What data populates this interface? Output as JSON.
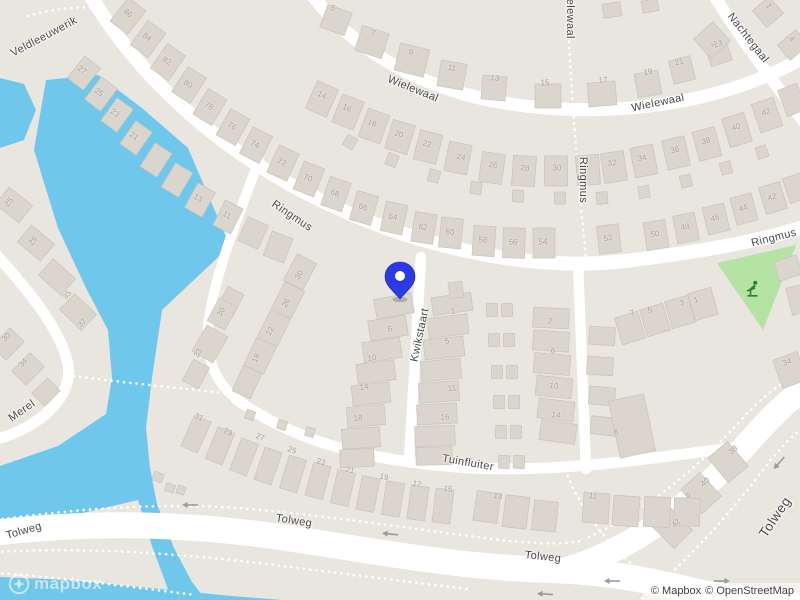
{
  "marker": {
    "x": 400,
    "y": 284
  },
  "branding": {
    "logo_text": "mapbox"
  },
  "attribution": {
    "mapbox": "© Mapbox",
    "openstreetmap": "© OpenStreetMap"
  },
  "colors": {
    "water": "#6fc7ec",
    "land": "#e9e6e0",
    "road": "#ffffff",
    "building": "#dad5cd",
    "building_outline": "#c9c3ba",
    "park": "#b5e3a4",
    "park_icon": "#2e7d32",
    "pin": "#2b3ae2",
    "street_label": "#474747",
    "house_number": "#a5a198"
  },
  "street_labels": [
    {
      "text": "Veldleeuwerik",
      "x": 44,
      "y": 37,
      "rot": -28
    },
    {
      "text": "Wielewaal",
      "x": 413,
      "y": 89,
      "rot": 22
    },
    {
      "text": "Wielewaal",
      "x": 570,
      "y": 12,
      "rot": 90
    },
    {
      "text": "Wielewaal",
      "x": 658,
      "y": 103,
      "rot": -12
    },
    {
      "text": "Nachtegaal",
      "x": 748,
      "y": 38,
      "rot": 52
    },
    {
      "text": "Ringmus",
      "x": 292,
      "y": 216,
      "rot": 34
    },
    {
      "text": "Ringmus",
      "x": 583,
      "y": 180,
      "rot": 90
    },
    {
      "text": "Ringmus",
      "x": 774,
      "y": 238,
      "rot": -14
    },
    {
      "text": "Kwikstaart",
      "x": 420,
      "y": 335,
      "rot": -78
    },
    {
      "text": "Tuinfluiter",
      "x": 468,
      "y": 463,
      "rot": 10
    },
    {
      "text": "Merel",
      "x": 22,
      "y": 411,
      "rot": -35
    },
    {
      "text": "Tolweg",
      "x": 24,
      "y": 531,
      "rot": -16
    },
    {
      "text": "Tolweg",
      "x": 294,
      "y": 521,
      "rot": 9
    },
    {
      "text": "Tolweg",
      "x": 543,
      "y": 557,
      "rot": 6
    },
    {
      "text": "Tolweg",
      "x": 775,
      "y": 517,
      "rot": -56,
      "big": true
    }
  ],
  "house_numbers": [
    {
      "n": "86",
      "x": 128,
      "y": 13,
      "rot": 38
    },
    {
      "n": "84",
      "x": 147,
      "y": 37,
      "rot": 36
    },
    {
      "n": "82",
      "x": 167,
      "y": 61,
      "rot": 35
    },
    {
      "n": "80",
      "x": 188,
      "y": 84,
      "rot": 33
    },
    {
      "n": "78",
      "x": 209,
      "y": 106,
      "rot": 31
    },
    {
      "n": "76",
      "x": 232,
      "y": 126,
      "rot": 29
    },
    {
      "n": "74",
      "x": 255,
      "y": 144,
      "rot": 27
    },
    {
      "n": "72",
      "x": 282,
      "y": 162,
      "rot": 25
    },
    {
      "n": "70",
      "x": 308,
      "y": 178,
      "rot": 22
    },
    {
      "n": "68",
      "x": 335,
      "y": 193,
      "rot": 19
    },
    {
      "n": "66",
      "x": 363,
      "y": 207,
      "rot": 16
    },
    {
      "n": "64",
      "x": 393,
      "y": 217,
      "rot": 12
    },
    {
      "n": "62",
      "x": 423,
      "y": 227,
      "rot": 9
    },
    {
      "n": "60",
      "x": 450,
      "y": 232,
      "rot": 6
    },
    {
      "n": "58",
      "x": 483,
      "y": 240,
      "rot": 4
    },
    {
      "n": "56",
      "x": 513,
      "y": 242,
      "rot": 2
    },
    {
      "n": "54",
      "x": 543,
      "y": 242,
      "rot": 0
    },
    {
      "n": "52",
      "x": 608,
      "y": 238,
      "rot": -7
    },
    {
      "n": "50",
      "x": 655,
      "y": 234,
      "rot": -9
    },
    {
      "n": "48",
      "x": 685,
      "y": 227,
      "rot": -11
    },
    {
      "n": "46",
      "x": 715,
      "y": 218,
      "rot": -13
    },
    {
      "n": "44",
      "x": 743,
      "y": 208,
      "rot": -15
    },
    {
      "n": "42",
      "x": 772,
      "y": 197,
      "rot": -17
    },
    {
      "n": "27",
      "x": 82,
      "y": 70,
      "rot": 38
    },
    {
      "n": "25",
      "x": 99,
      "y": 92,
      "rot": 37
    },
    {
      "n": "23",
      "x": 115,
      "y": 113,
      "rot": 36
    },
    {
      "n": "21",
      "x": 134,
      "y": 136,
      "rot": 35
    },
    {
      "n": "13",
      "x": 198,
      "y": 198,
      "rot": 30
    },
    {
      "n": "11",
      "x": 227,
      "y": 215,
      "rot": 27
    },
    {
      "n": "5",
      "x": 333,
      "y": 8,
      "rot": 20
    },
    {
      "n": "7",
      "x": 373,
      "y": 33,
      "rot": 18
    },
    {
      "n": "9",
      "x": 411,
      "y": 52,
      "rot": 14
    },
    {
      "n": "11",
      "x": 452,
      "y": 68,
      "rot": 10
    },
    {
      "n": "13",
      "x": 495,
      "y": 78,
      "rot": 5
    },
    {
      "n": "15",
      "x": 545,
      "y": 83,
      "rot": 0
    },
    {
      "n": "17",
      "x": 603,
      "y": 80,
      "rot": -5
    },
    {
      "n": "19",
      "x": 648,
      "y": 72,
      "rot": -10
    },
    {
      "n": "21",
      "x": 679,
      "y": 62,
      "rot": -14
    },
    {
      "n": "23",
      "x": 718,
      "y": 44,
      "rot": -20
    },
    {
      "n": "2",
      "x": 714,
      "y": 44,
      "rot": 50
    },
    {
      "n": "1",
      "x": 769,
      "y": 6,
      "rot": 50
    },
    {
      "n": "4",
      "x": 792,
      "y": 39,
      "rot": 50
    },
    {
      "n": "14",
      "x": 322,
      "y": 95,
      "rot": 24
    },
    {
      "n": "16",
      "x": 347,
      "y": 108,
      "rot": 22
    },
    {
      "n": "18",
      "x": 372,
      "y": 123,
      "rot": 20
    },
    {
      "n": "20",
      "x": 399,
      "y": 134,
      "rot": 17
    },
    {
      "n": "22",
      "x": 427,
      "y": 144,
      "rot": 14
    },
    {
      "n": "24",
      "x": 461,
      "y": 157,
      "rot": 11
    },
    {
      "n": "26",
      "x": 493,
      "y": 165,
      "rot": 8
    },
    {
      "n": "28",
      "x": 525,
      "y": 168,
      "rot": 4
    },
    {
      "n": "30",
      "x": 557,
      "y": 168,
      "rot": 0
    },
    {
      "n": "32",
      "x": 612,
      "y": 163,
      "rot": -8
    },
    {
      "n": "34",
      "x": 642,
      "y": 158,
      "rot": -11
    },
    {
      "n": "36",
      "x": 675,
      "y": 150,
      "rot": -13
    },
    {
      "n": "38",
      "x": 706,
      "y": 141,
      "rot": -15
    },
    {
      "n": "40",
      "x": 736,
      "y": 127,
      "rot": -17
    },
    {
      "n": "42",
      "x": 766,
      "y": 112,
      "rot": -19
    },
    {
      "n": "30",
      "x": 299,
      "y": 275,
      "rot": -62
    },
    {
      "n": "26",
      "x": 286,
      "y": 303,
      "rot": -63
    },
    {
      "n": "22",
      "x": 270,
      "y": 331,
      "rot": -64
    },
    {
      "n": "18",
      "x": 256,
      "y": 358,
      "rot": -65
    },
    {
      "n": "30",
      "x": 221,
      "y": 312,
      "rot": -62
    },
    {
      "n": "33",
      "x": 198,
      "y": 353,
      "rot": -60
    },
    {
      "n": "6",
      "x": 390,
      "y": 329,
      "rot": -8
    },
    {
      "n": "10",
      "x": 372,
      "y": 358,
      "rot": -7
    },
    {
      "n": "14",
      "x": 364,
      "y": 387,
      "rot": -6
    },
    {
      "n": "18",
      "x": 358,
      "y": 418,
      "rot": -4
    },
    {
      "n": "1",
      "x": 453,
      "y": 311,
      "rot": -6
    },
    {
      "n": "5",
      "x": 447,
      "y": 341,
      "rot": -6
    },
    {
      "n": "11",
      "x": 452,
      "y": 388,
      "rot": -4
    },
    {
      "n": "16",
      "x": 445,
      "y": 417,
      "rot": -3
    },
    {
      "n": "2",
      "x": 550,
      "y": 321,
      "rot": 4
    },
    {
      "n": "6",
      "x": 553,
      "y": 351,
      "rot": 5
    },
    {
      "n": "10",
      "x": 554,
      "y": 386,
      "rot": 6
    },
    {
      "n": "14",
      "x": 556,
      "y": 415,
      "rot": 7
    },
    {
      "n": "7",
      "x": 632,
      "y": 313,
      "rot": -17
    },
    {
      "n": "5",
      "x": 650,
      "y": 310,
      "rot": -17
    },
    {
      "n": "3",
      "x": 682,
      "y": 303,
      "rot": -16
    },
    {
      "n": "1",
      "x": 696,
      "y": 300,
      "rot": -16
    },
    {
      "n": "34",
      "x": 787,
      "y": 362,
      "rot": -20
    },
    {
      "n": "25",
      "x": 9,
      "y": 202,
      "rot": -50
    },
    {
      "n": "29",
      "x": 33,
      "y": 241,
      "rot": -49
    },
    {
      "n": "35",
      "x": 67,
      "y": 295,
      "rot": -47
    },
    {
      "n": "37",
      "x": 82,
      "y": 323,
      "rot": -45
    },
    {
      "n": "30",
      "x": 6,
      "y": 337,
      "rot": -46
    },
    {
      "n": "34",
      "x": 23,
      "y": 363,
      "rot": -45
    },
    {
      "n": "31",
      "x": 199,
      "y": 417,
      "rot": 24
    },
    {
      "n": "29",
      "x": 228,
      "y": 432,
      "rot": 22
    },
    {
      "n": "27",
      "x": 260,
      "y": 437,
      "rot": 20
    },
    {
      "n": "25",
      "x": 292,
      "y": 450,
      "rot": 18
    },
    {
      "n": "23",
      "x": 321,
      "y": 462,
      "rot": 16
    },
    {
      "n": "21",
      "x": 350,
      "y": 470,
      "rot": 14
    },
    {
      "n": "19",
      "x": 384,
      "y": 477,
      "rot": 12
    },
    {
      "n": "17",
      "x": 417,
      "y": 484,
      "rot": 10
    },
    {
      "n": "15",
      "x": 448,
      "y": 489,
      "rot": 8
    },
    {
      "n": "13",
      "x": 498,
      "y": 496,
      "rot": 8
    },
    {
      "n": "11",
      "x": 593,
      "y": 496,
      "rot": 5
    },
    {
      "n": "9",
      "x": 688,
      "y": 496,
      "rot": 2
    },
    {
      "n": "38",
      "x": 733,
      "y": 450,
      "rot": -40
    },
    {
      "n": "40",
      "x": 705,
      "y": 482,
      "rot": -42
    },
    {
      "n": "42",
      "x": 676,
      "y": 523,
      "rot": -45
    },
    {
      "n": "6",
      "x": 616,
      "y": 432,
      "rot": -10
    }
  ]
}
